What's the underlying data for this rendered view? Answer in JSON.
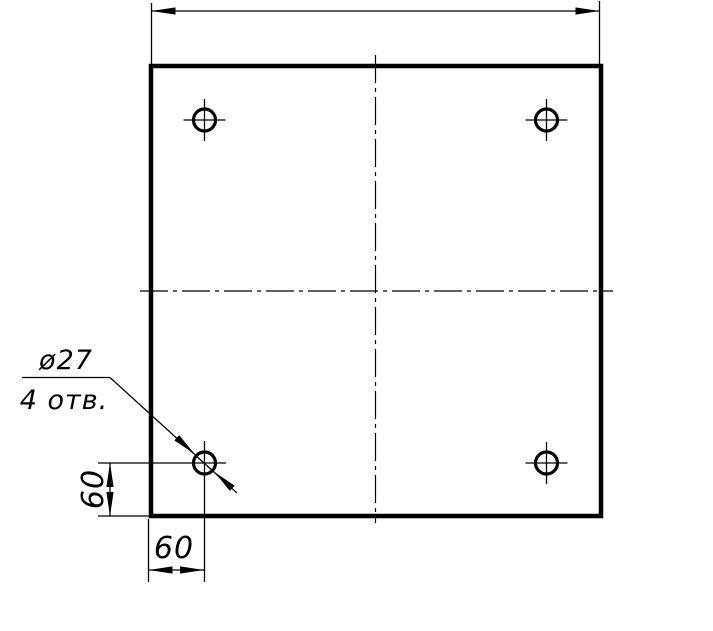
{
  "colors": {
    "ink": "#000000",
    "paper": "#ffffff"
  },
  "drawing": {
    "description": "Square plate front view with four drilled holes near the corners",
    "callout": {
      "diameter": "ø27",
      "count": "4 отв."
    },
    "dims": {
      "hole_offset_from_left_edge": "60",
      "hole_offset_from_bottom_edge": "60",
      "overall_width_label": ""
    },
    "holes": {
      "count": 4,
      "positions": [
        "top-left",
        "top-right",
        "bottom-left",
        "bottom-right"
      ]
    }
  }
}
